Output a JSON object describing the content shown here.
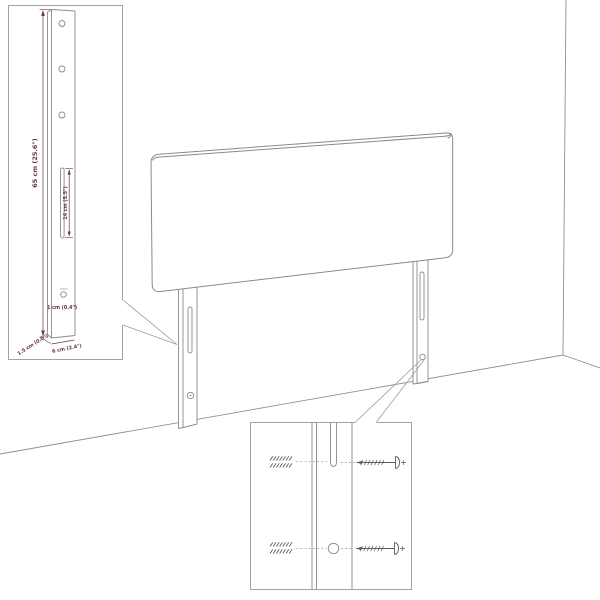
{
  "diagram": {
    "type": "furniture-assembly-diagram",
    "subject": "headboard with two wall-mount legs in room corner",
    "post_detail_inset": {
      "labels": {
        "height": "65 cm (25.6\")",
        "slot_length": "14 cm (5.5\")",
        "hole_diameter": "1 cm (0.4\")",
        "thickness": "1.5 cm (0.6\")",
        "width": "6 cm (2.4\")"
      },
      "icons": [
        "post-side-view-icon",
        "mounting-slot-icon",
        "mounting-hole-icon"
      ]
    },
    "mounting_detail_inset": {
      "icons": [
        "wall-plug-icon",
        "screw-icon",
        "leg-slot-icon",
        "leg-hole-icon"
      ]
    },
    "main_illustration": {
      "icons": [
        "headboard-panel-icon",
        "left-leg-icon",
        "right-leg-icon",
        "wall-corner-icon",
        "floor-line-icon"
      ]
    },
    "colors": {
      "line": "#8a8a8a",
      "border": "#a3a3a3",
      "callout": "#9b9b9b",
      "dimension_text": "#6a3453",
      "hardware": "#5a5a5a",
      "background": "#ffffff"
    }
  }
}
